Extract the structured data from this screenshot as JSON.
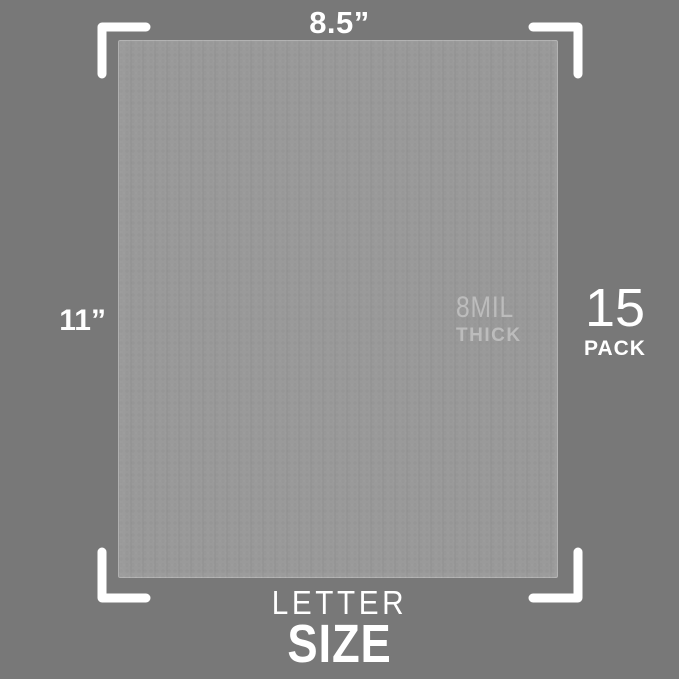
{
  "image": {
    "width_label": "8.5”",
    "height_label": "11”",
    "thickness": {
      "value": "8MIL",
      "word": "THICK"
    },
    "pack": {
      "count": "15",
      "word": "PACK"
    },
    "size": {
      "line1": "LETTER",
      "line2": "SIZE"
    }
  },
  "colors": {
    "background": "#787878",
    "sheet": "#9a9a9a",
    "text": "#ffffff",
    "watermark": "#bcbcbc",
    "bracket": "#ffffff"
  }
}
